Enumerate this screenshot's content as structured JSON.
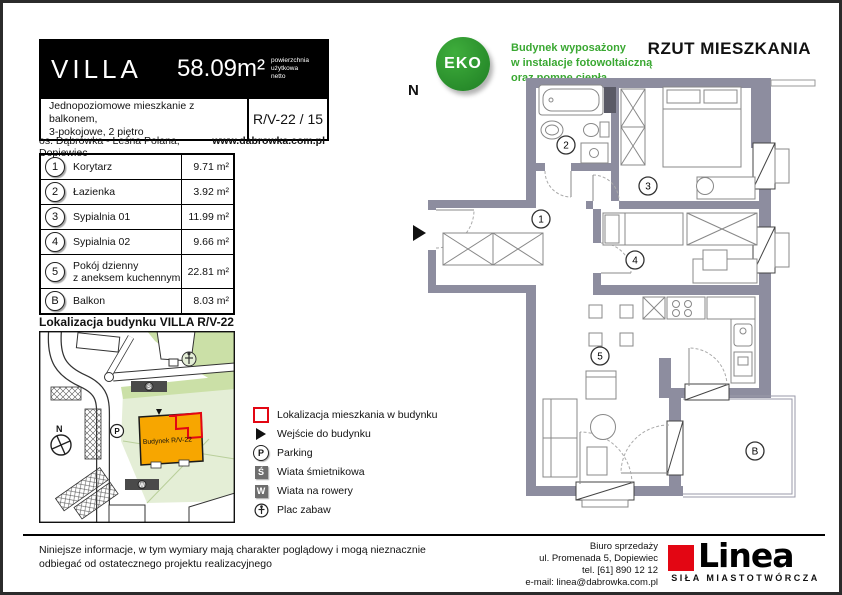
{
  "header": {
    "brand": "VILLA",
    "area": "58.09m²",
    "area_note_1": "powierzchnia",
    "area_note_2": "użytkowa",
    "area_note_3": "netto",
    "description_1": "Jednopoziomowe mieszkanie z balkonem,",
    "description_2": "3-pokojowe, 2 piętro",
    "unit_code": "R/V-22 / 15",
    "location": "os. Dąbrówka - Leśna Polana, Dopiewiec",
    "website": "www.dabrowka.com.pl"
  },
  "rooms": {
    "items": [
      {
        "no": "1",
        "name": "Korytarz",
        "name2": "",
        "area": "9.71 m²"
      },
      {
        "no": "2",
        "name": "Łazienka",
        "name2": "",
        "area": "3.92 m²"
      },
      {
        "no": "3",
        "name": "Sypialnia 01",
        "name2": "",
        "area": "11.99 m²"
      },
      {
        "no": "4",
        "name": "Sypialnia 02",
        "name2": "",
        "area": "9.66 m²"
      },
      {
        "no": "5",
        "name": "Pokój dzienny",
        "name2": "z aneksem kuchennym",
        "area": "22.81 m²"
      },
      {
        "no": "B",
        "name": "Balkon",
        "name2": "",
        "area": "8.03 m²"
      }
    ]
  },
  "eco": {
    "badge": "EKO",
    "line1": "Budynek wyposażony",
    "line2": "w instalacje fotowoltaiczną",
    "line3": "oraz pompę ciepła"
  },
  "plan": {
    "title": "RZUT MIESZKANIA",
    "compass": "N",
    "badges": [
      "1",
      "2",
      "3",
      "4",
      "5",
      "B"
    ]
  },
  "map": {
    "title": "Lokalizacja budynku  VILLA R/V-22",
    "building_label": "Budynek R/V-22",
    "compass": "N",
    "parking_letter": "P",
    "trash_letter": "Ś",
    "bike_letter": "W"
  },
  "legend": {
    "items": [
      "Lokalizacja mieszkania w budynku",
      "Wejście do budynku",
      "Parking",
      "Wiata śmietnikowa",
      "Wiata na rowery",
      "Plac zabaw"
    ],
    "parking_letter": "P",
    "trash_letter": "Ś",
    "bike_letter": "W"
  },
  "footer": {
    "disclaimer_1": "Niniejsze informacje, w tym wymiary mają charakter poglądowy i mogą nieznacznie",
    "disclaimer_2": "odbiegać od ostatecznego projektu realizacyjnego",
    "office_1": "Biuro sprzedaży",
    "office_2": "ul. Promenada 5, Dopiewiec",
    "office_3": "tel. [61] 890 12 12",
    "office_4": "e-mail: linea@dabrowka.com.pl",
    "logo_text": "Linea",
    "logo_tagline": "SIŁA MIASTOTWÓRCZA"
  },
  "colors": {
    "accent_red": "#e30613",
    "eco_green": "#2f9e33",
    "wall_gray": "#8d8d9f",
    "building_orange": "#f7a600"
  }
}
